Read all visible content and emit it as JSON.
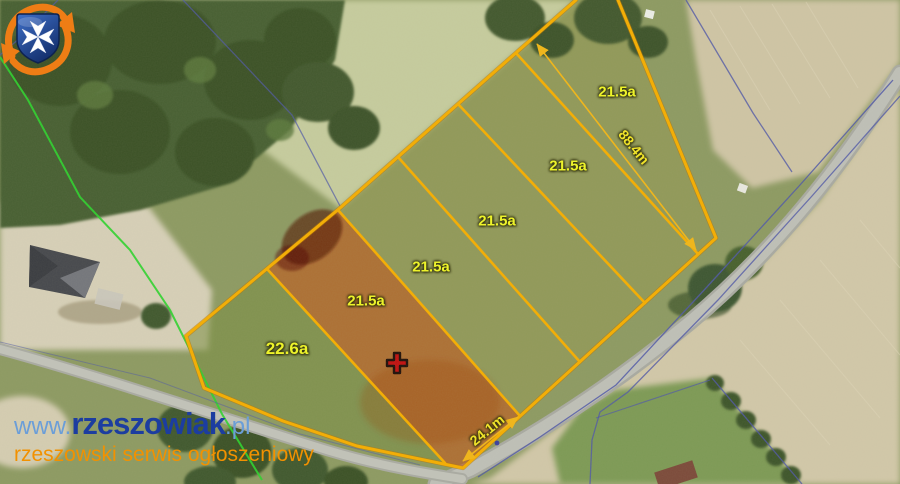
{
  "map": {
    "description": "aerial parcel subdivision map",
    "parcel_labels": [
      {
        "area": "21.5a"
      },
      {
        "area": "21.5a"
      },
      {
        "area": "21.5a"
      },
      {
        "area": "21.5a"
      },
      {
        "area": "21.5a"
      },
      {
        "area": "22.6a"
      }
    ],
    "dimension_labels": [
      {
        "value": "88.4m"
      },
      {
        "value": "24.1m"
      }
    ],
    "marker": {
      "type": "selected-parcel-cross"
    },
    "colors": {
      "parcel_boundary": "#f6ae00",
      "parcel_label": "#edf32b",
      "selected_parcel_fill": "rgba(196,78,22,0.55)",
      "dimension_line": "#f2b617",
      "cadastral_line": "#5058a8",
      "utility_line": "#2ed32e"
    }
  },
  "watermark": {
    "prefix": "www.",
    "name": "rzeszowiak",
    "tld": ".pl",
    "tagline": "rzeszowski serwis ogłoszeniowy"
  }
}
